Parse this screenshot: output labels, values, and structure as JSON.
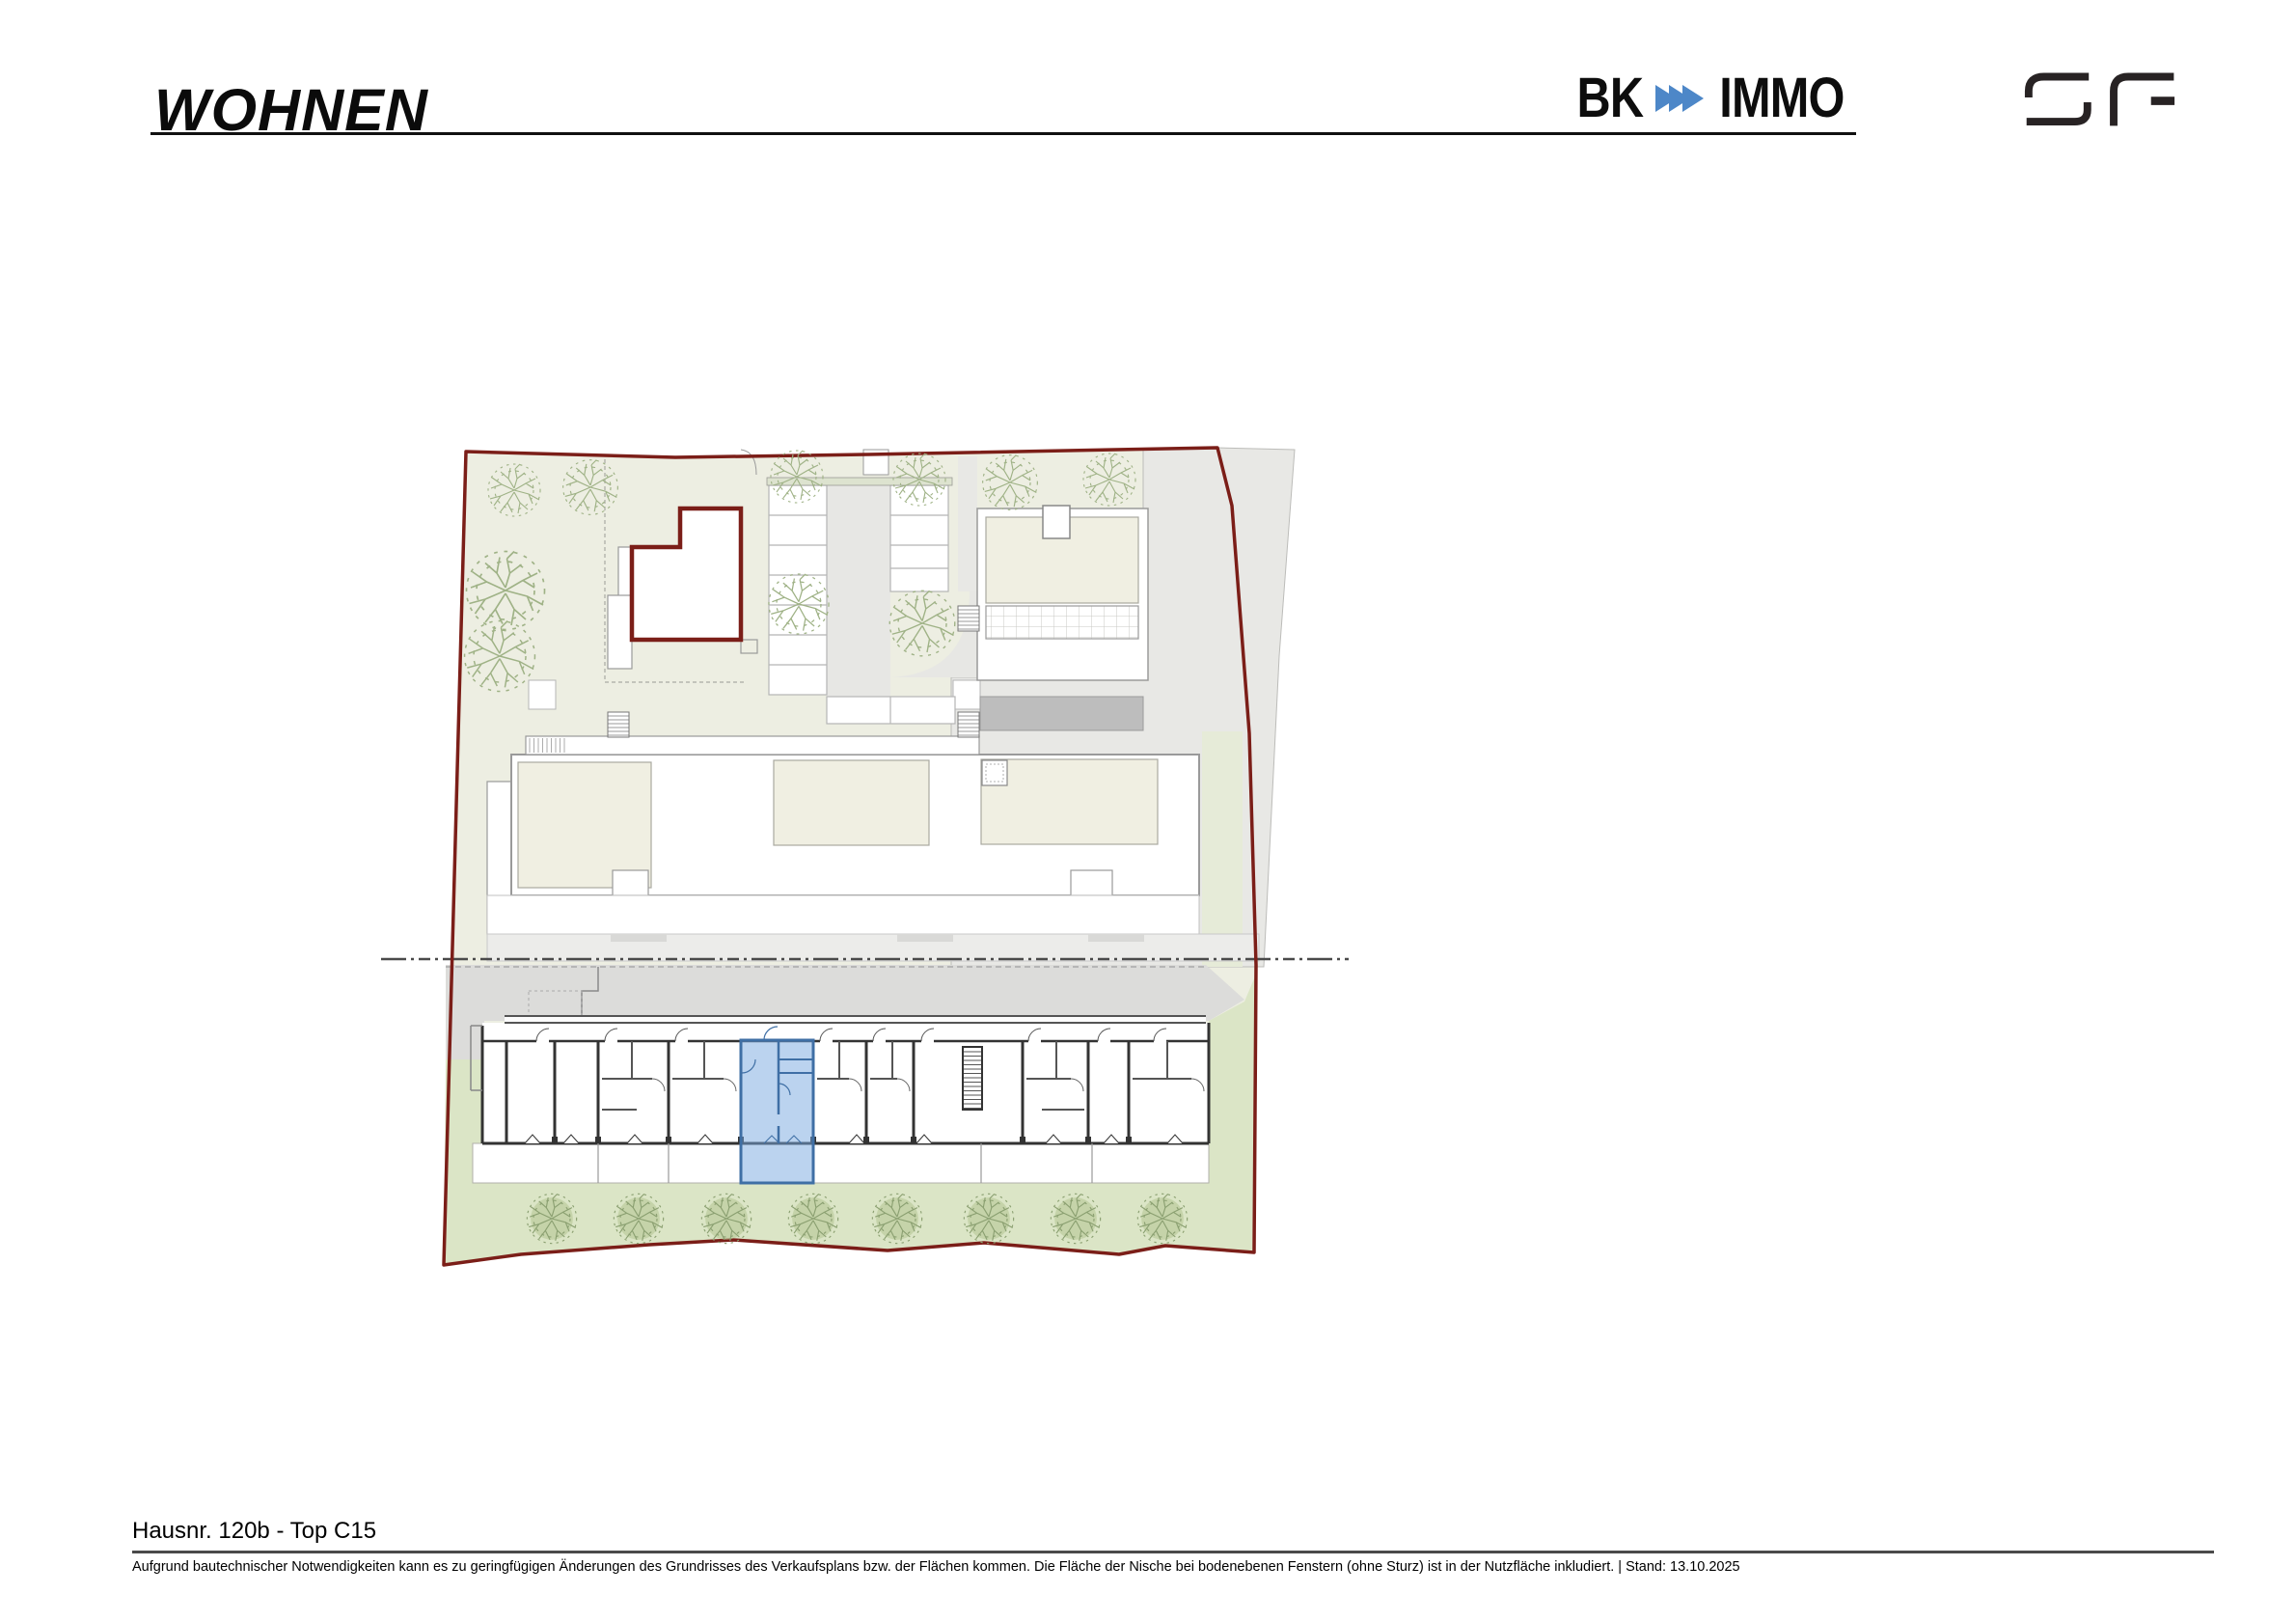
{
  "header": {
    "section_title": "WOHNEN"
  },
  "logos": {
    "bk_immo": {
      "left_text": "BK",
      "right_text": "IMMO",
      "arrow_color": "#4d87c8",
      "arrow_count": 3
    },
    "sf_monogram_name": "sf-logo"
  },
  "plan": {
    "highlighted_unit": {
      "id": "Top C15",
      "house": "Hausnr. 120b",
      "fill": "#b5d3ef",
      "outline": "#3f6fa5"
    },
    "colors": {
      "boundary_red": "#7b1e18",
      "ground_green": "#edeee2",
      "garden_green": "#dbe5c6",
      "paving_gray": "#e8e8e5",
      "street_gray": "#dcdcda",
      "roof_cream": "#f0efe2"
    }
  },
  "footer": {
    "unit_title": "Hausnr. 120b - Top C15",
    "disclaimer": "Aufgrund bautechnischer Notwendigkeiten kann es zu geringfügigen Änderungen des Grundrisses des Verkaufsplans bzw. der Flächen kommen. Die Fläche der Nische bei bodenebenen Fenstern (ohne Sturz) ist in der Nutzfläche inkludiert. | Stand: 13.10.2025"
  }
}
